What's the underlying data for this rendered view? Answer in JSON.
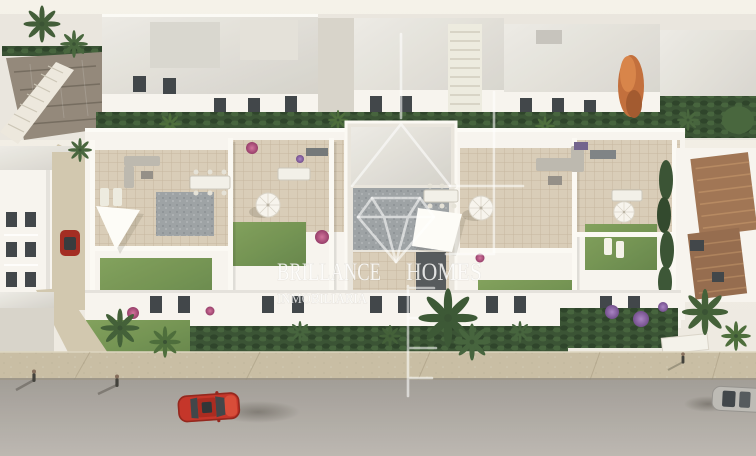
{
  "watermark": {
    "word_left": "BRILLANCE",
    "word_right": "HOMES",
    "subtitle": "INMOBILIARIA",
    "logo_icon": "house-diamond-logo"
  },
  "colors": {
    "sky": "#f2eee6",
    "wall-light": "#f7f4ee",
    "wall-mid": "#e8e4db",
    "wall-shade": "#d6d1c7",
    "roof-gray": "#dedbd4",
    "roof-dark": "#96999d",
    "tile": "#d7cab4",
    "tile-dark": "#c8baa2",
    "lawn": "#6f9150",
    "lawn-dark": "#597c3e",
    "hedge": "#2d4827",
    "hedge-dark": "#20371d",
    "palm": "#3f6134",
    "flower-pink": "#b84e7e",
    "flower-purple": "#8a5f9e",
    "tree-orange": "#bf6630",
    "terracotta": "#9a6c4a",
    "terracotta-light": "#b28258",
    "stone": "#8c8173",
    "path": "#cfc4ab",
    "sidewalk": "#c5ba9f",
    "road": "#a7a29c",
    "car-red": "#c1271b",
    "car-silver": "#b9b6b1",
    "window-dark": "#343a3e",
    "watermark-white": "#ffffff"
  }
}
